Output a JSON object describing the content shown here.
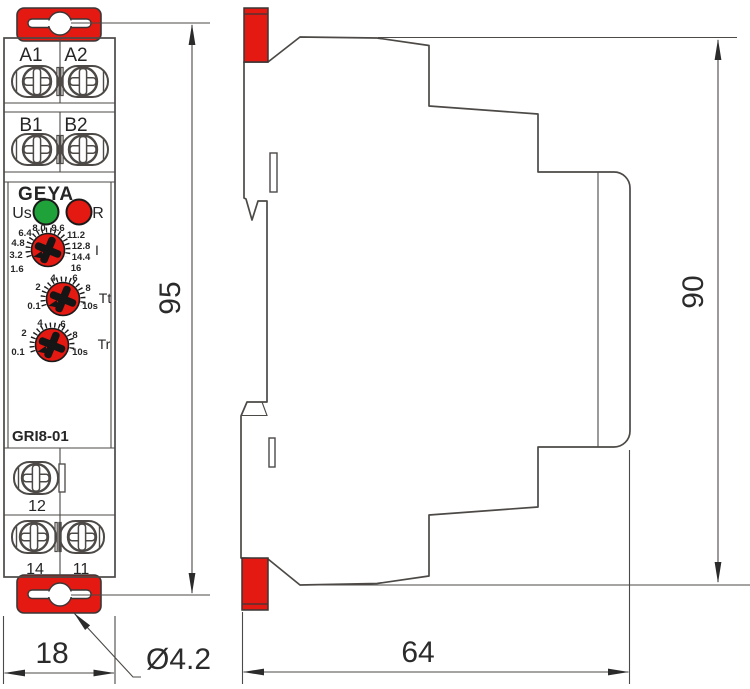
{
  "front_view": {
    "terminals_row_a": [
      "A1",
      "A2"
    ],
    "terminals_row_b": [
      "B1",
      "B2"
    ],
    "brand_logo": "GEYA",
    "led_supply_label": "Us",
    "led_relay_label": "R",
    "current_dial": {
      "label": "I",
      "scale": [
        "1.6",
        "3.2",
        "4.8",
        "6.4",
        "8.0",
        "9.6",
        "11.2",
        "12.8",
        "14.4",
        "16"
      ]
    },
    "tt_dial": {
      "label": "Tt",
      "scale": [
        "0.1",
        "2",
        "4",
        "6",
        "8",
        "10s"
      ]
    },
    "tr_dial": {
      "label": "Tr",
      "scale": [
        "0.1",
        "2",
        "4",
        "6",
        "8",
        "10s"
      ]
    },
    "model_label": "GRI8-01",
    "terminal_12": "12",
    "terminal_14": "14",
    "terminal_11": "11"
  },
  "dimensions": {
    "front_height": "95",
    "front_width": "18",
    "hole_diameter": "Ø4.2",
    "side_height": "90",
    "side_depth": "64"
  },
  "colors": {
    "accent_red": "#e41911",
    "led_green": "#1fa23a",
    "led_red": "#e41911",
    "line_dark": "#4c4946"
  }
}
